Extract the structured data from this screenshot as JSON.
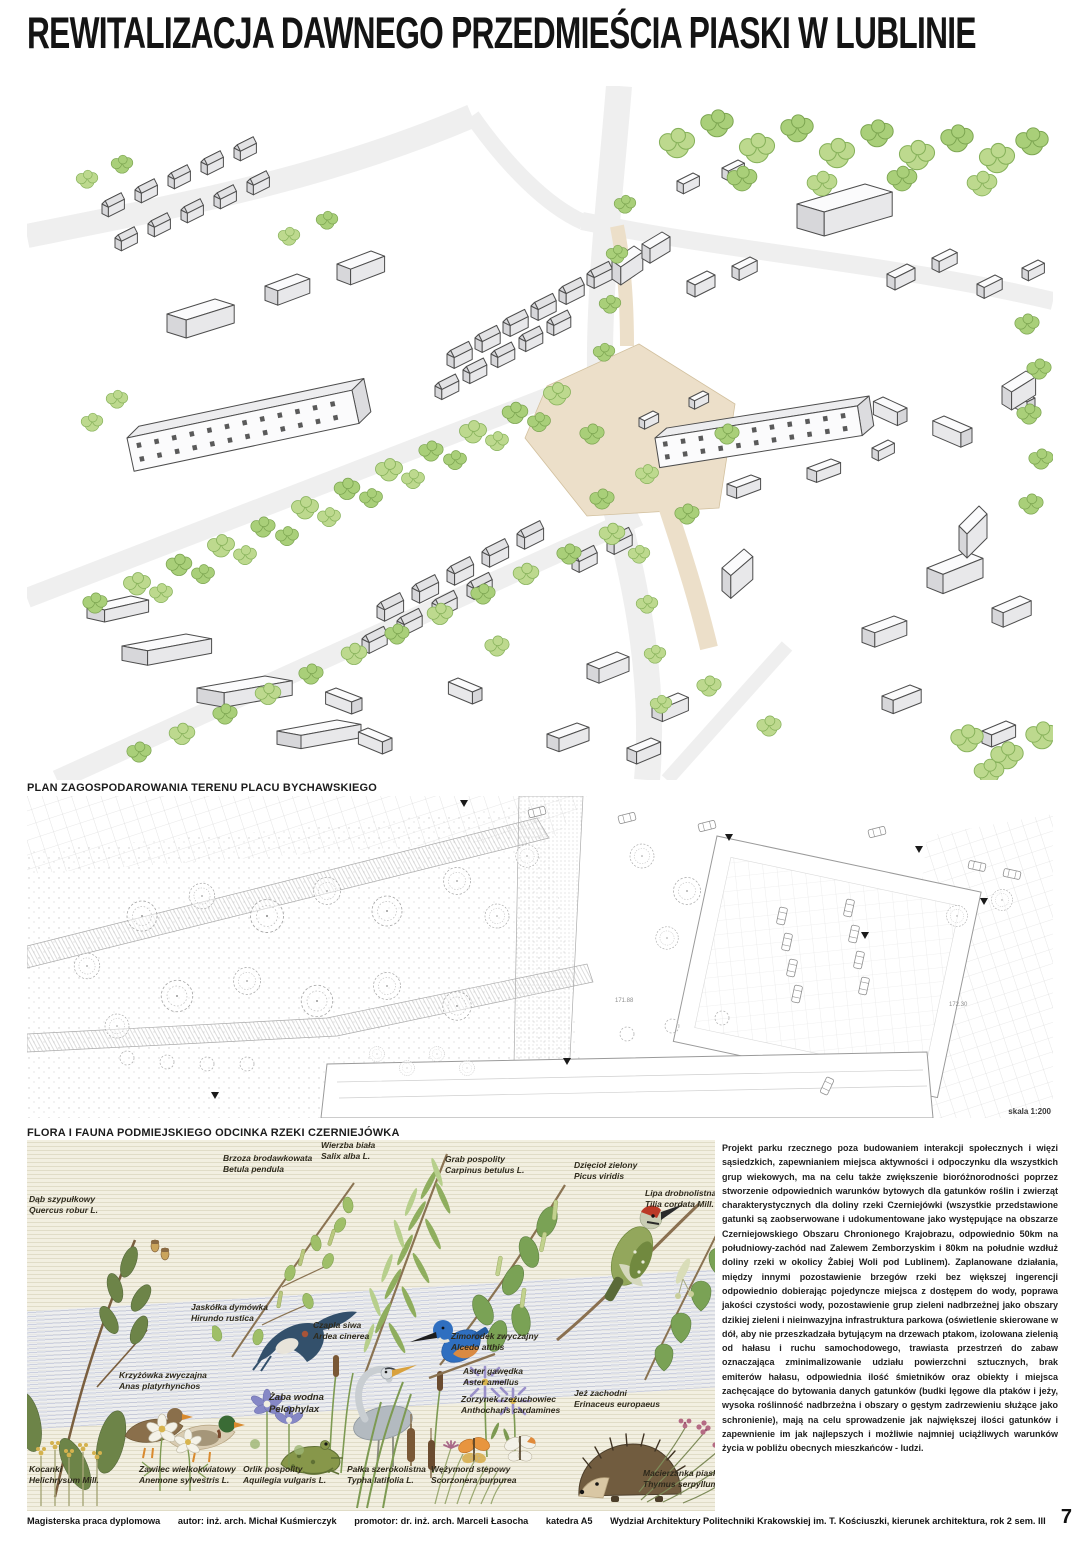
{
  "page": {
    "title": "REWITALIZACJA DAWNEGO PRZEDMIEŚCIA PIASKI W LUBLINIE",
    "page_number": "7"
  },
  "site_plan": {
    "label": "PLAN ZAGOSPODAROWANIA TERENU PLACU BYCHAWSKIEGO",
    "scale_note": "skala 1:200",
    "annotations": [
      "171.88",
      "172.30"
    ]
  },
  "flora": {
    "label": "FLORA I FAUNA PODMIEJSKIEGO ODCINKA RZEKI CZERNIEJÓWKA",
    "species": [
      {
        "pl": "Dąb szypułkowy",
        "lat": "Quercus robur L."
      },
      {
        "pl": "Brzoza brodawkowata",
        "lat": "Betula pendula"
      },
      {
        "pl": "Wierzba biała",
        "lat": "Salix alba L."
      },
      {
        "pl": "Grab pospolity",
        "lat": "Carpinus betulus L."
      },
      {
        "pl": "Dzięcioł zielony",
        "lat": "Picus viridis"
      },
      {
        "pl": "Lipa drobnolistna",
        "lat": "Tilia cordata Mill."
      },
      {
        "pl": "Jaskółka dymówka",
        "lat": "Hirundo rustica"
      },
      {
        "pl": "Czapla siwa",
        "lat": "Ardea cinerea"
      },
      {
        "pl": "Zimorodek zwyczajny",
        "lat": "Alcedo atthis"
      },
      {
        "pl": "Krzyżówka zwyczajna",
        "lat": "Anas platyrhynchos"
      },
      {
        "pl": "Żaba wodna",
        "lat": "Pelophylax"
      },
      {
        "pl": "Aster gawędka",
        "lat": "Aster amellus"
      },
      {
        "pl": "Zorzynek rzeżuchowiec",
        "lat": "Anthocharis cardamines"
      },
      {
        "pl": "Jeż zachodni",
        "lat": "Erinaceus europaeus"
      },
      {
        "pl": "Kocanki",
        "lat": "Helichrysum Mill."
      },
      {
        "pl": "Zawilec wielkokwiatowy",
        "lat": "Anemone sylvestris L."
      },
      {
        "pl": "Orlik pospolity",
        "lat": "Aquilegia vulgaris L."
      },
      {
        "pl": "Pałka szerokolistna",
        "lat": "Typha latifolia L."
      },
      {
        "pl": "Wężymord stepowy",
        "lat": "Scorzonera purpurea"
      },
      {
        "pl": "Macierzanka piaskowa",
        "lat": "Thymus serpyllum L."
      }
    ]
  },
  "description": {
    "text": "Projekt parku rzecznego poza budowaniem interakcji społecznych i więzi sąsiedzkich, zapewnianiem miejsca aktywności i odpoczynku dla wszystkich grup wiekowych, ma na celu także zwiększenie bioróżnorodności poprzez stworzenie odpowiednich warunków bytowych dla gatunków roślin i zwierząt charakterystycznych dla doliny rzeki Czerniejówki (wszystkie przedstawione gatunki są zaobserwowane i udokumentowane jako występujące na obszarze Czerniejowskiego Obszaru Chronionego Krajobrazu, odpowiednio 50km na południowy-zachód nad Zalewem Zemborzyskim i 80km na południe wzdłuż doliny rzeki w okolicy Żabiej Woli pod Lublinem). Zaplanowane działania, między innymi pozostawienie brzegów rzeki bez większej ingerencji odpowiednio dobierając pojedyncze miejsca z dostępem do wody, poprawa jakości czystości wody, pozostawienie grup zieleni nadbrzeżnej jako obszary dzikiej zieleni i nieinwazyjna infrastruktura parkowa (oświetlenie skierowane w dół, aby nie przeszkadzała bytującym na drzewach ptakom, izolowana zielenią od hałasu i ruchu samochodowego, trawiasta przestrzeń do zabaw oznaczająca zminimalizowanie udziału powierzchni sztucznych, brak emiterów hałasu, odpowiednia ilość śmietników oraz obiekty i miejsca zachęcające do bytowania danych gatunków (budki lęgowe dla ptaków i jeży, wysoka roślinność nadbrzeżna i obszary o gęstym zadrzewieniu służące jako schronienie), mają na celu sprowadzenie jak największej ilości gatunków i zapewnienie im jak najlepszych i możliwie najmniej uciążliwych warunków życia w pobliżu obecnych mieszkańców - ludzi."
  },
  "footer": {
    "items": [
      "Magisterska praca dyplomowa",
      "autor: inż. arch. Michał Kuśmierczyk",
      "promotor: dr. inż. arch. Marceli Łasocha",
      "katedra A5",
      "Wydział Architektury Politechniki Krakowskiej im. T. Kościuszki, kierunek architektura, rok 2 sem. III"
    ]
  },
  "colors": {
    "tree_green": "#b5d583",
    "plaza_beige": "#ecdfc9",
    "flora_cream": "#f2efe1",
    "line_gray": "#9a9a9a"
  }
}
